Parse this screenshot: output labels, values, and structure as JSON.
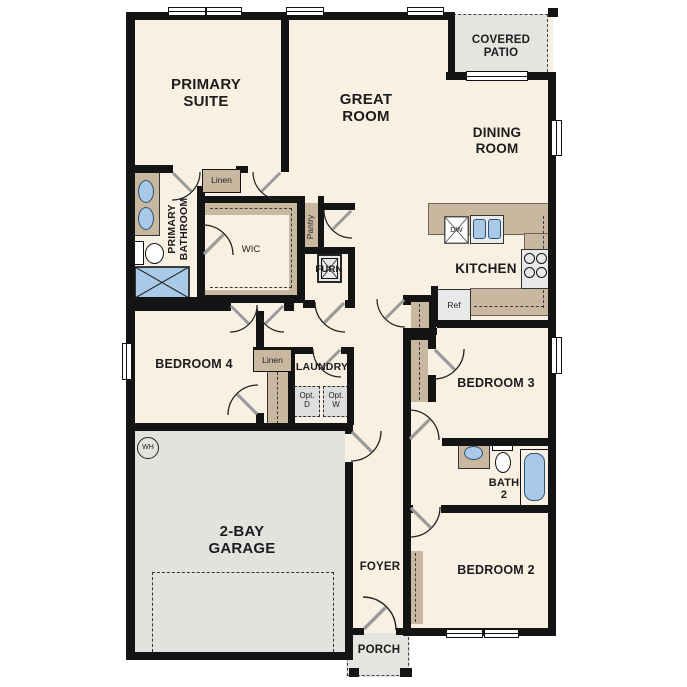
{
  "plan": {
    "title": "Single-story home floor plan",
    "rooms": {
      "primary_suite": "PRIMARY\nSUITE",
      "great_room": "GREAT\nROOM",
      "covered_patio": "COVERED\nPATIO",
      "dining_room": "DINING\nROOM",
      "kitchen": "KITCHEN",
      "primary_bathroom": "PRIMARY\nBATHROOM",
      "wic": "WIC",
      "bedroom4": "BEDROOM 4",
      "laundry": "LAUNDRY",
      "garage": "2-BAY\nGARAGE",
      "bedroom3": "BEDROOM 3",
      "bath2": "BATH\n2",
      "foyer": "FOYER",
      "bedroom2": "BEDROOM 2",
      "porch": "PORCH"
    },
    "closets": {
      "linen_upper": "Linen",
      "linen_hall": "Linen",
      "pantry": "Pantry"
    },
    "appliances": {
      "furnace": "FURN",
      "dishwasher": "DW",
      "refrigerator": "Ref",
      "water_heater": "WH",
      "opt_dryer": "Opt.\nD",
      "opt_washer": "Opt.\nW"
    },
    "colors": {
      "floor": "#f8f0e3",
      "patio_gray": "#e4e4e1",
      "cabinet_tan": "#c9b8a0",
      "fixture_blue": "#a9c9e9",
      "wall": "#141414"
    }
  }
}
